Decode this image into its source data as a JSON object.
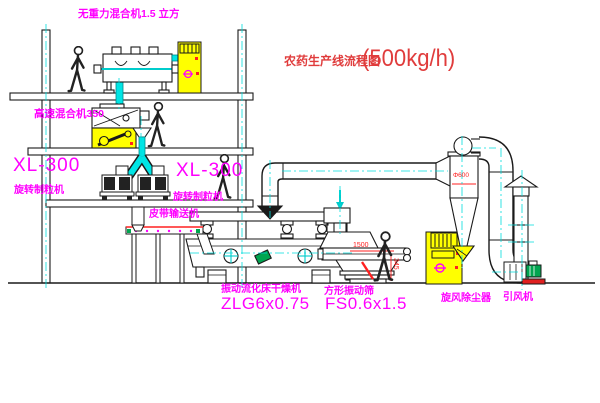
{
  "title": {
    "name": "农药生产线流程图",
    "capacity": "(500kg/h)"
  },
  "labels": {
    "gravity_mixer": "无重力混合机1.5 立方",
    "high_speed_mixer": "高速混合机350",
    "granulator_left_model": "XL-300",
    "granulator_left_name": "旋转制粒机",
    "granulator_right_model": "XL-300",
    "granulator_right_name": "旋转制粒机",
    "belt_conveyor": "皮带输送机",
    "dryer_name": "振动流化床干燥机",
    "dryer_model": "ZLG6x0.75",
    "sieve_name": "方形振动筛",
    "sieve_model": "FS0.6x1.5",
    "cyclone_name": "旋风除尘器",
    "fan_name": "引风机"
  },
  "dimensions": {
    "sieve_length": "1500",
    "sieve_outlet_height": "345",
    "cyclone_diameter": "Φ600"
  },
  "colors": {
    "title": "#e03c3c",
    "label": "#ff00ff",
    "centerline": "#00dddd",
    "dimension": "#ff2020",
    "cabinet": "#ffff00",
    "motor_green": "#00a550",
    "line": "#1a1a1a",
    "background": "#ffffff"
  }
}
